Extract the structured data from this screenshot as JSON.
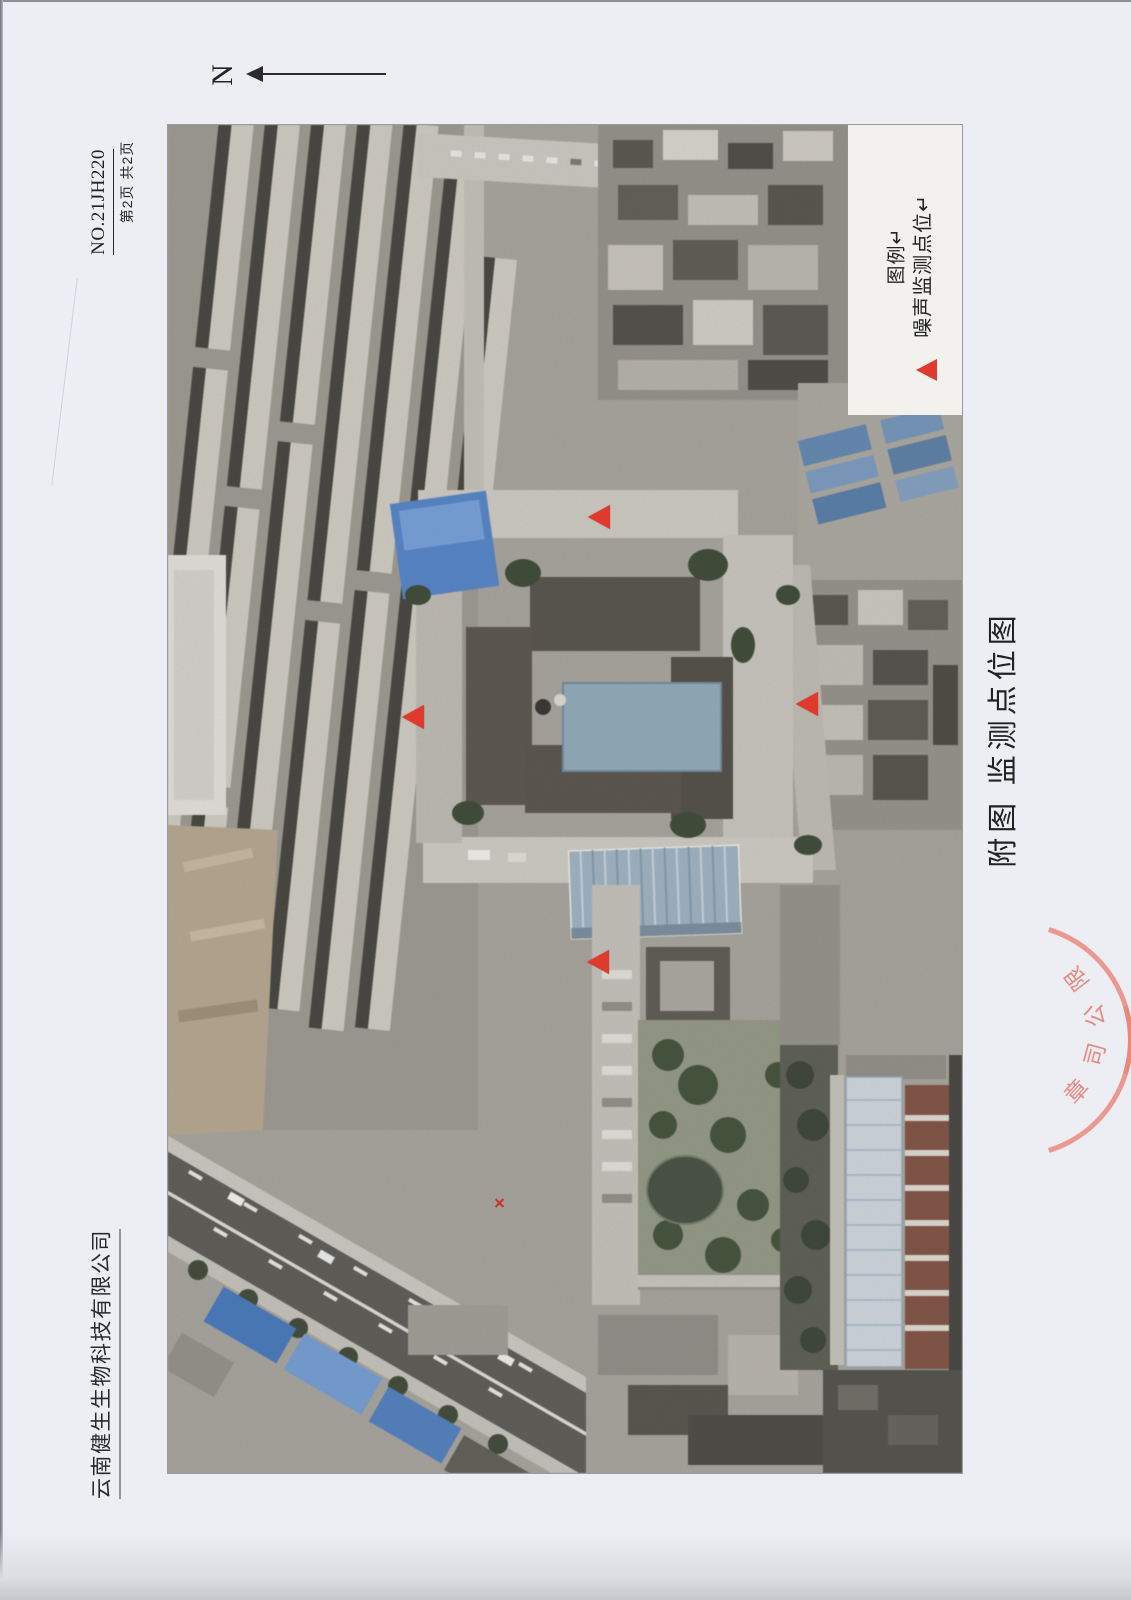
{
  "page": {
    "doc_no": "NO.21JH220",
    "page_info": "第2页 共2页",
    "company_footer": "云南健生生物科技有限公司",
    "caption": "附图 监测点位图",
    "north_label": "N",
    "paper_color": "#edeef4"
  },
  "legend": {
    "title": "图例↵",
    "item": "噪声监测点位↵",
    "marker_color": "#e03a2d"
  },
  "stamp": {
    "visible_text": "限公司章",
    "chars": [
      "限",
      "公",
      "司",
      "章"
    ],
    "color": "#e5786c"
  },
  "map": {
    "marker_color": "#e03a2d",
    "markers": [
      {
        "type": "triangle",
        "x": 599,
        "y": 517
      },
      {
        "type": "triangle",
        "x": 413,
        "y": 717
      },
      {
        "type": "triangle",
        "x": 807,
        "y": 704
      },
      {
        "type": "triangle",
        "x": 598,
        "y": 962
      },
      {
        "type": "cross",
        "x": 499,
        "y": 1203
      }
    ]
  }
}
